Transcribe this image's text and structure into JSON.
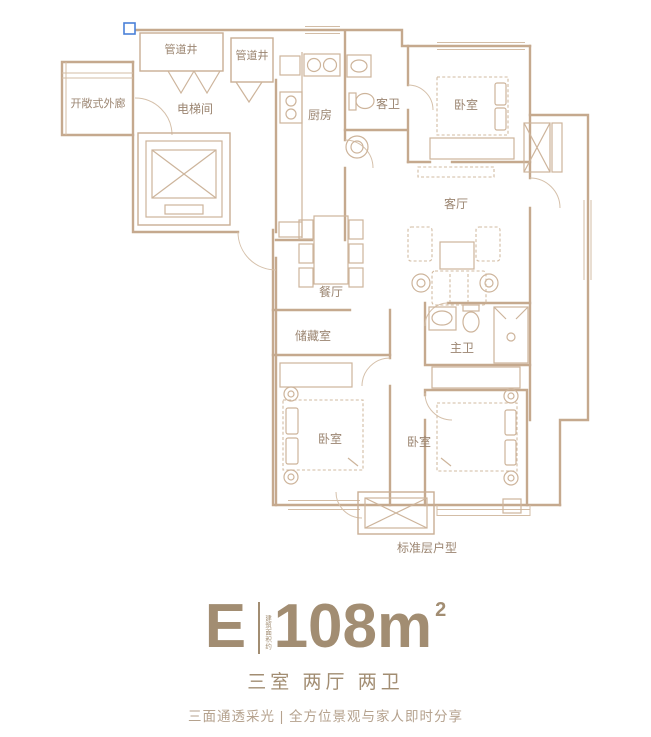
{
  "floorplan": {
    "caption": "标准层户型",
    "rooms": {
      "pipe_shaft_1": "管道井",
      "pipe_shaft_2": "管道井",
      "open_corridor": "开敞式外廊",
      "elevator_hall": "电梯间",
      "kitchen": "厨房",
      "guest_bath": "客卫",
      "bedroom_top": "卧室",
      "living_room": "客厅",
      "dining_room": "餐厅",
      "storage": "储藏室",
      "master_bath": "主卫",
      "bedroom_left": "卧室",
      "bedroom_right": "卧室"
    },
    "colors": {
      "wall": "#c5a98e",
      "furniture": "#cdb49b",
      "label": "#9b8571",
      "selection_handle": "#4a80d9"
    }
  },
  "unit_info": {
    "unit_letter": "E",
    "area_prefix": "建筑面积约",
    "area_number": "108",
    "area_unit": "m",
    "area_exponent": "2",
    "layout_summary": "三室 两厅 两卫",
    "tagline": "三面通透采光 | 全方位景观与家人即时分享",
    "text_color": "#a28d72",
    "tagline_color": "#b5a28e"
  }
}
